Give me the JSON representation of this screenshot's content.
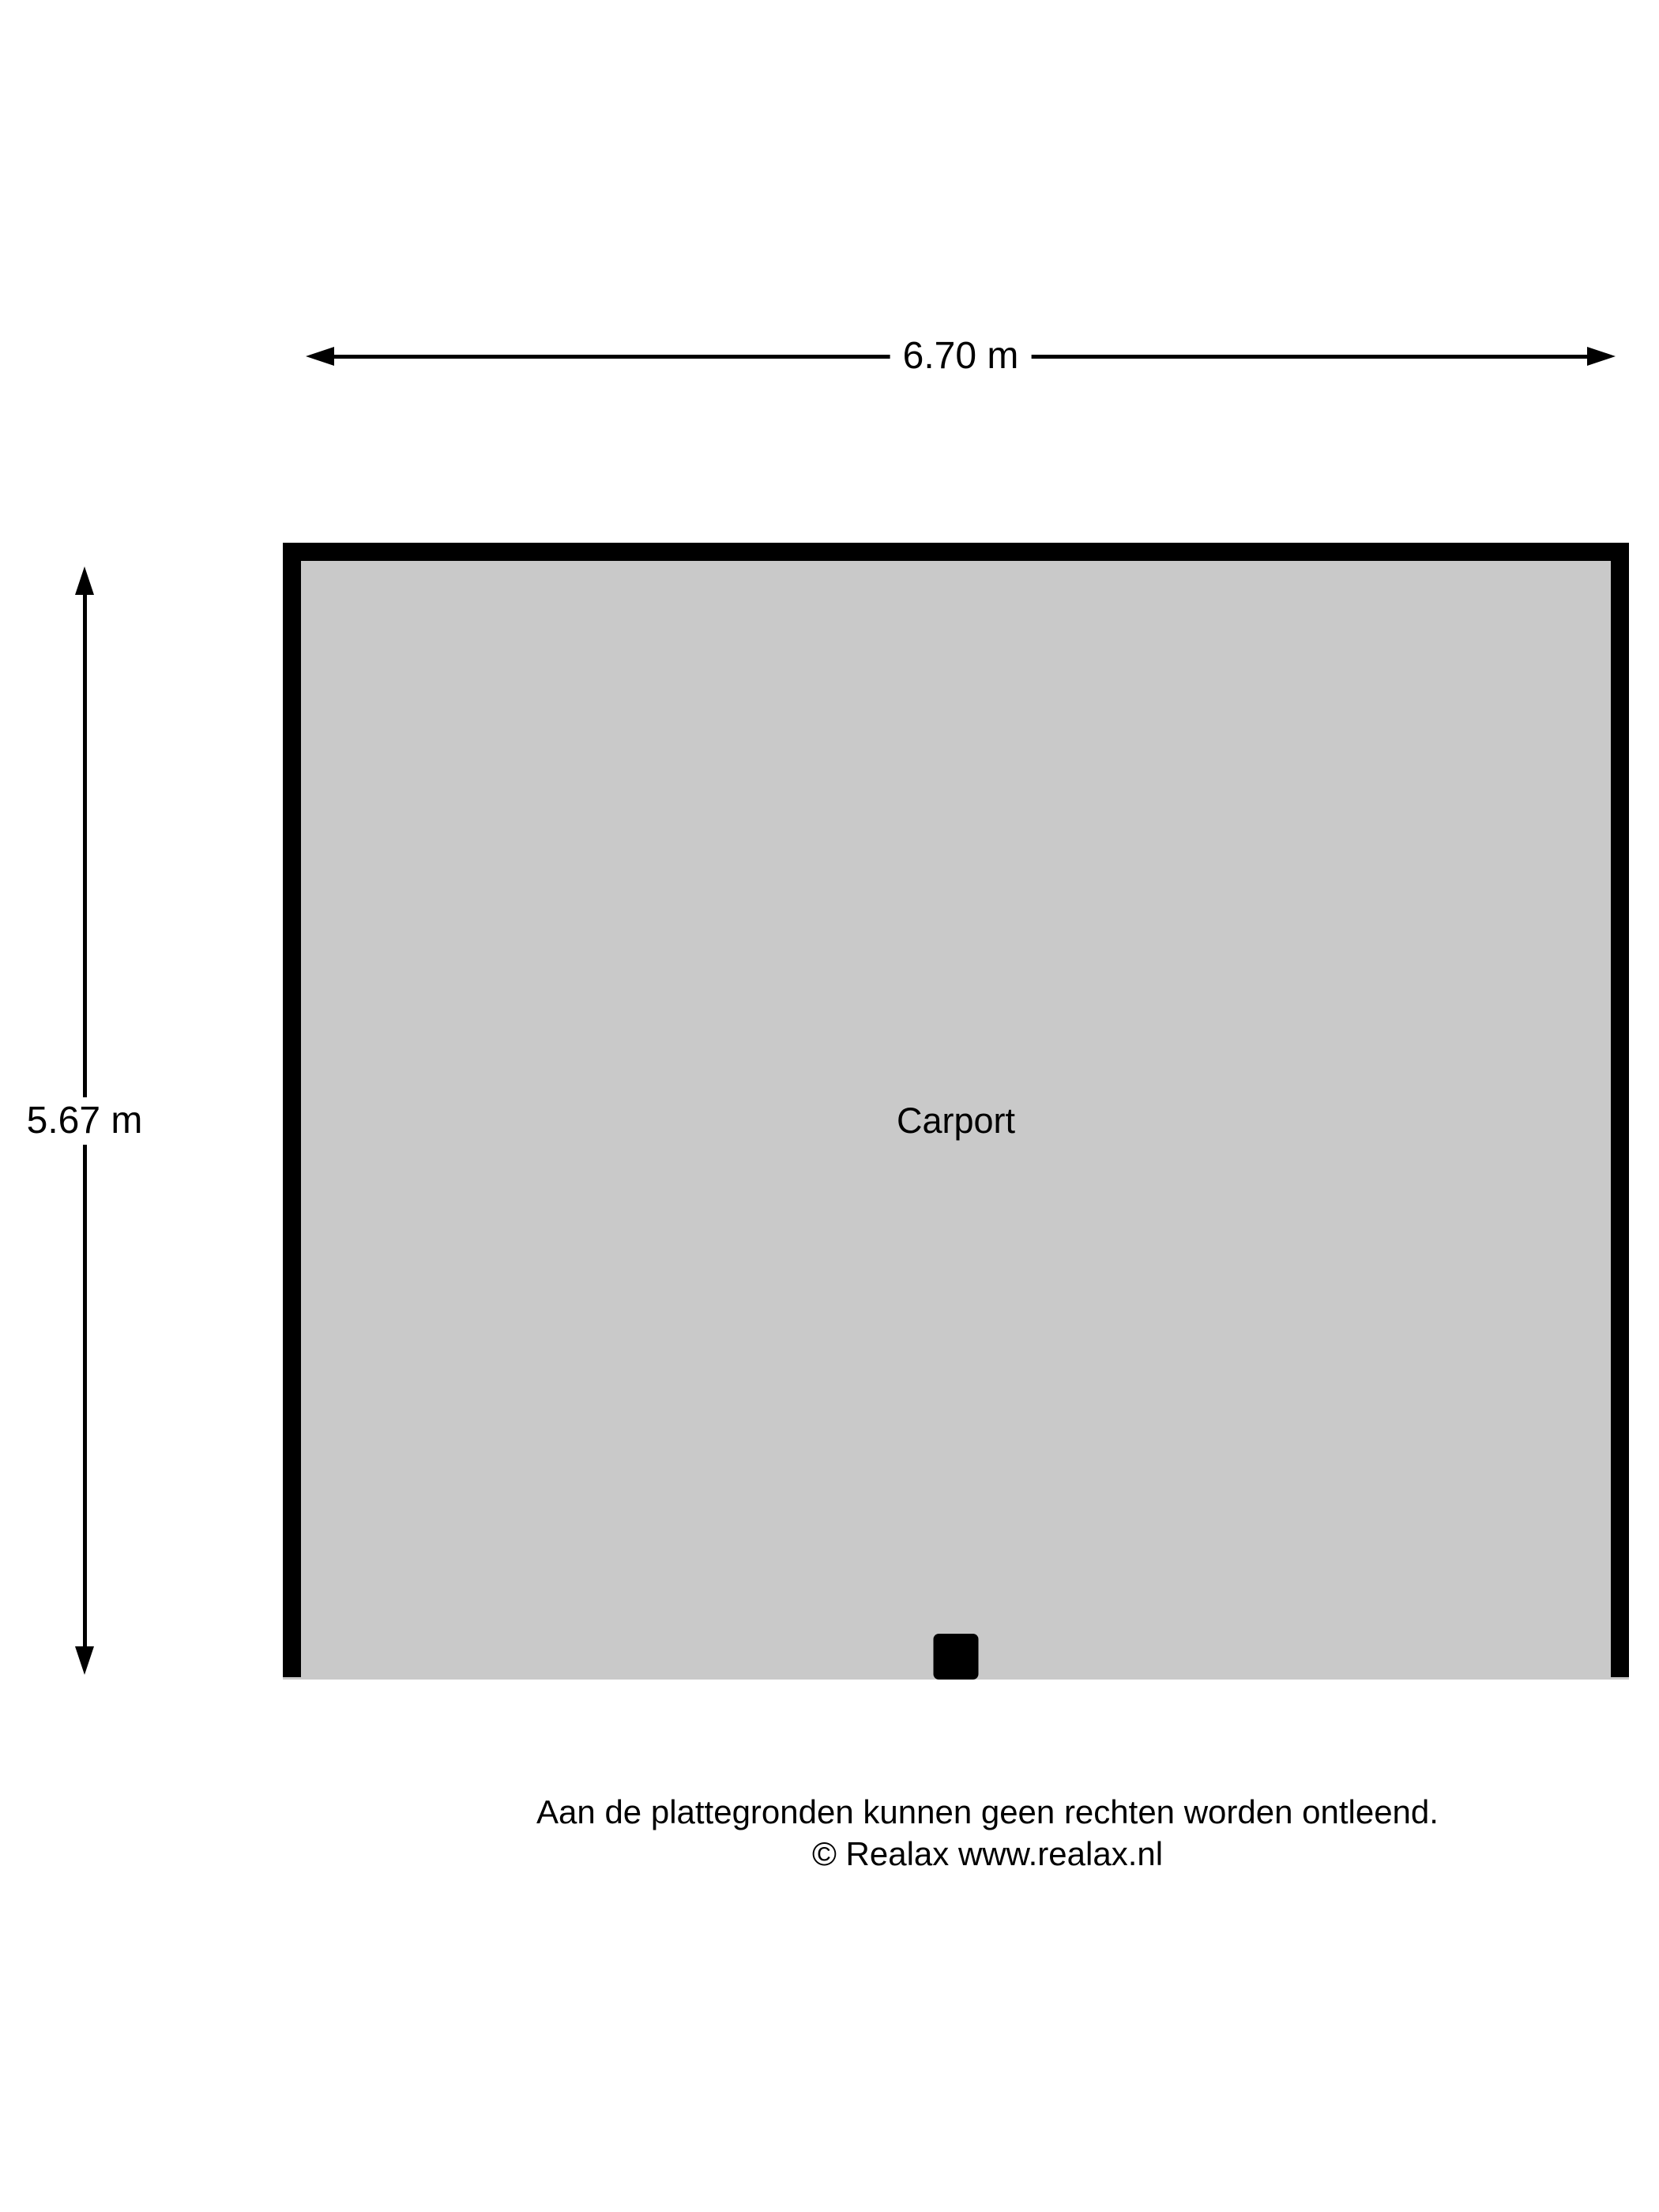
{
  "dimensions": {
    "horizontal": {
      "label": "6.70 m"
    },
    "vertical": {
      "label": "5.67 m"
    }
  },
  "room": {
    "label": "Carport"
  },
  "footer": {
    "line1": "Aan de plattegronden kunnen geen rechten worden ontleend.",
    "line2": "© Realax www.realax.nl"
  },
  "colors": {
    "background": "#ffffff",
    "wall": "#000000",
    "floor": "#c9c9c9",
    "text": "#000000"
  }
}
